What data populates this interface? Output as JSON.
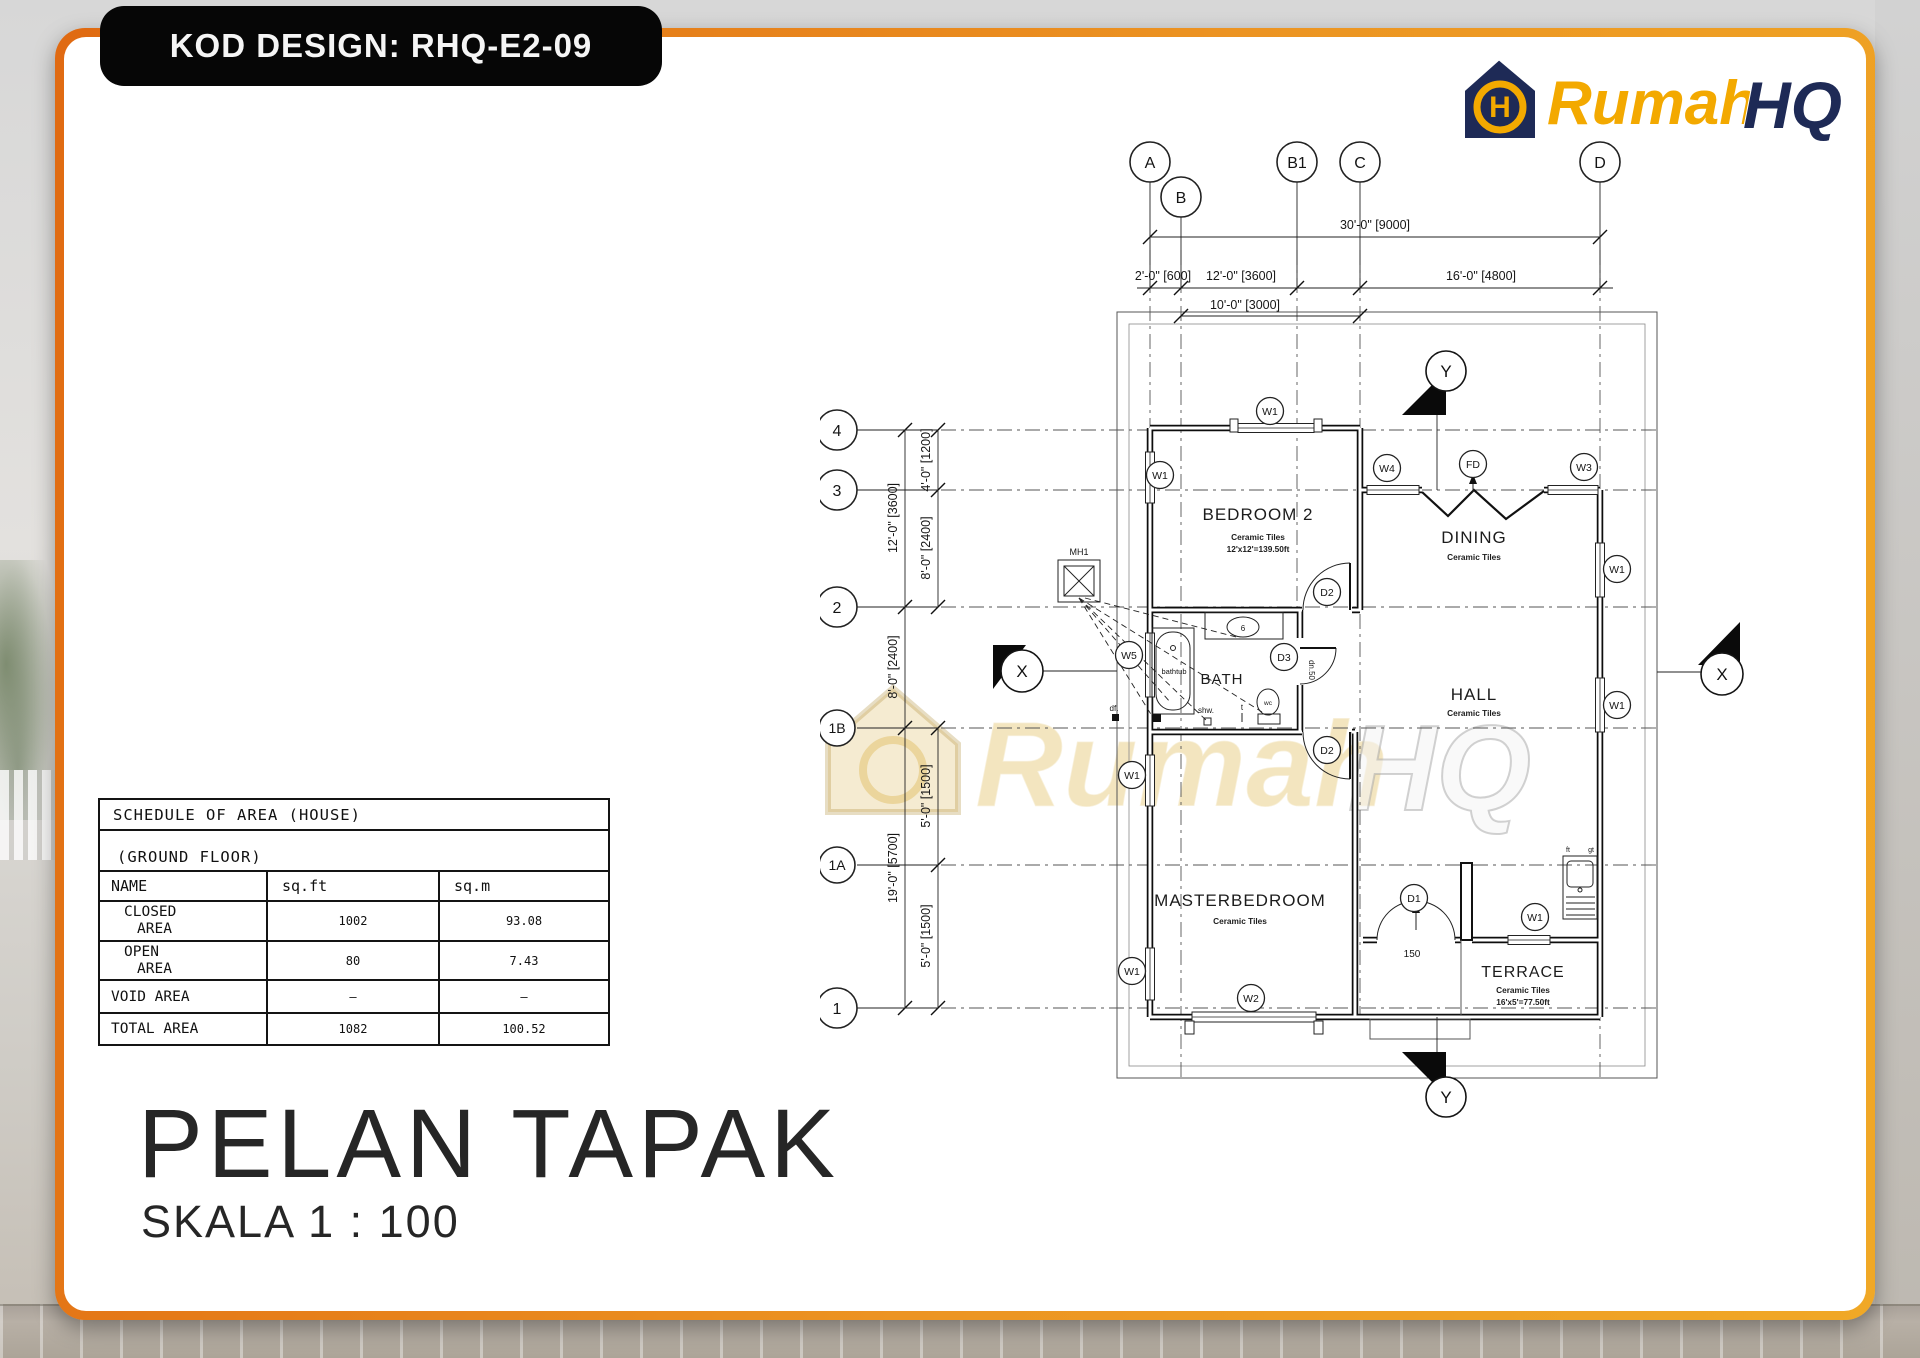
{
  "sheet": {
    "code_badge": "KOD DESIGN: RHQ-E2-09",
    "title": "PELAN TAPAK",
    "scale": "SKALA 1 : 100"
  },
  "logo": {
    "word1": "Rumah",
    "word2": "HQ",
    "monogram": "H"
  },
  "watermark": {
    "word1": "Rumah",
    "word2": "HQ"
  },
  "area_table": {
    "title": "SCHEDULE OF AREA (HOUSE)",
    "subtitle": "(GROUND FLOOR)",
    "columns": {
      "name": "NAME",
      "sqft": "sq.ft",
      "sqm": "sq.m"
    },
    "rows": [
      {
        "name1": "CLOSED",
        "name2": "AREA",
        "sqft": "1002",
        "sqm": "93.08"
      },
      {
        "name1": "OPEN",
        "name2": "AREA",
        "sqft": "80",
        "sqm": "7.43"
      },
      {
        "name1": "VOID AREA",
        "name2": "",
        "sqft": "–",
        "sqm": "–"
      },
      {
        "name1": "TOTAL AREA",
        "name2": "",
        "sqft": "1082",
        "sqm": "100.52"
      }
    ]
  },
  "grid": {
    "a": "A",
    "b": "B",
    "b1": "B1",
    "c": "C",
    "d": "D",
    "r4": "4",
    "r3": "3",
    "r2": "2",
    "r1b": "1B",
    "r1a": "1A",
    "r1": "1"
  },
  "dims": {
    "total_width": "30'-0\" [9000]",
    "ab": "2'-0\" [600]",
    "bb1": "12'-0\" [3600]",
    "cd": "16'-0\" [4800]",
    "bc": "10'-0\" [3000]",
    "v42": "12'-0\" [3600]",
    "v21b": "8'-0\" [2400]",
    "v1b1": "19'-0\" [5700]",
    "v43": "4'-0\" [1200]",
    "v32": "8'-0\" [2400]",
    "v1b1a": "5'-0\" [1500]",
    "v1a1": "5'-0\" [1500]"
  },
  "rooms": {
    "bedroom2": {
      "name": "BEDROOM 2",
      "finish": "Ceramic Tiles",
      "size": "12'x12'=139.50ft"
    },
    "dining": {
      "name": "DINING",
      "finish": "Ceramic Tiles"
    },
    "hall": {
      "name": "HALL",
      "finish": "Ceramic Tiles"
    },
    "bath": {
      "name": "BATH"
    },
    "master": {
      "name": "MASTERBEDROOM",
      "finish": "Ceramic Tiles"
    },
    "terrace": {
      "name": "TERRACE",
      "finish": "Ceramic Tiles",
      "size": "16'x5'=77.50ft"
    }
  },
  "tags": {
    "w1": "W1",
    "w2": "W2",
    "w3": "W3",
    "w4": "W4",
    "w5": "W5",
    "d1": "D1",
    "d2": "D2",
    "d3": "D3",
    "fd": "FD"
  },
  "sections": {
    "x": "X",
    "y": "Y"
  },
  "annotations": {
    "manhole": "MH1",
    "bathtub": "bathtub",
    "wc": "wc",
    "shower": "shw.",
    "floor_trap": "df.",
    "tap": "t",
    "basin": "6",
    "down": "dn.50",
    "door_width": "150",
    "ft": "ft",
    "gt": "gt"
  }
}
